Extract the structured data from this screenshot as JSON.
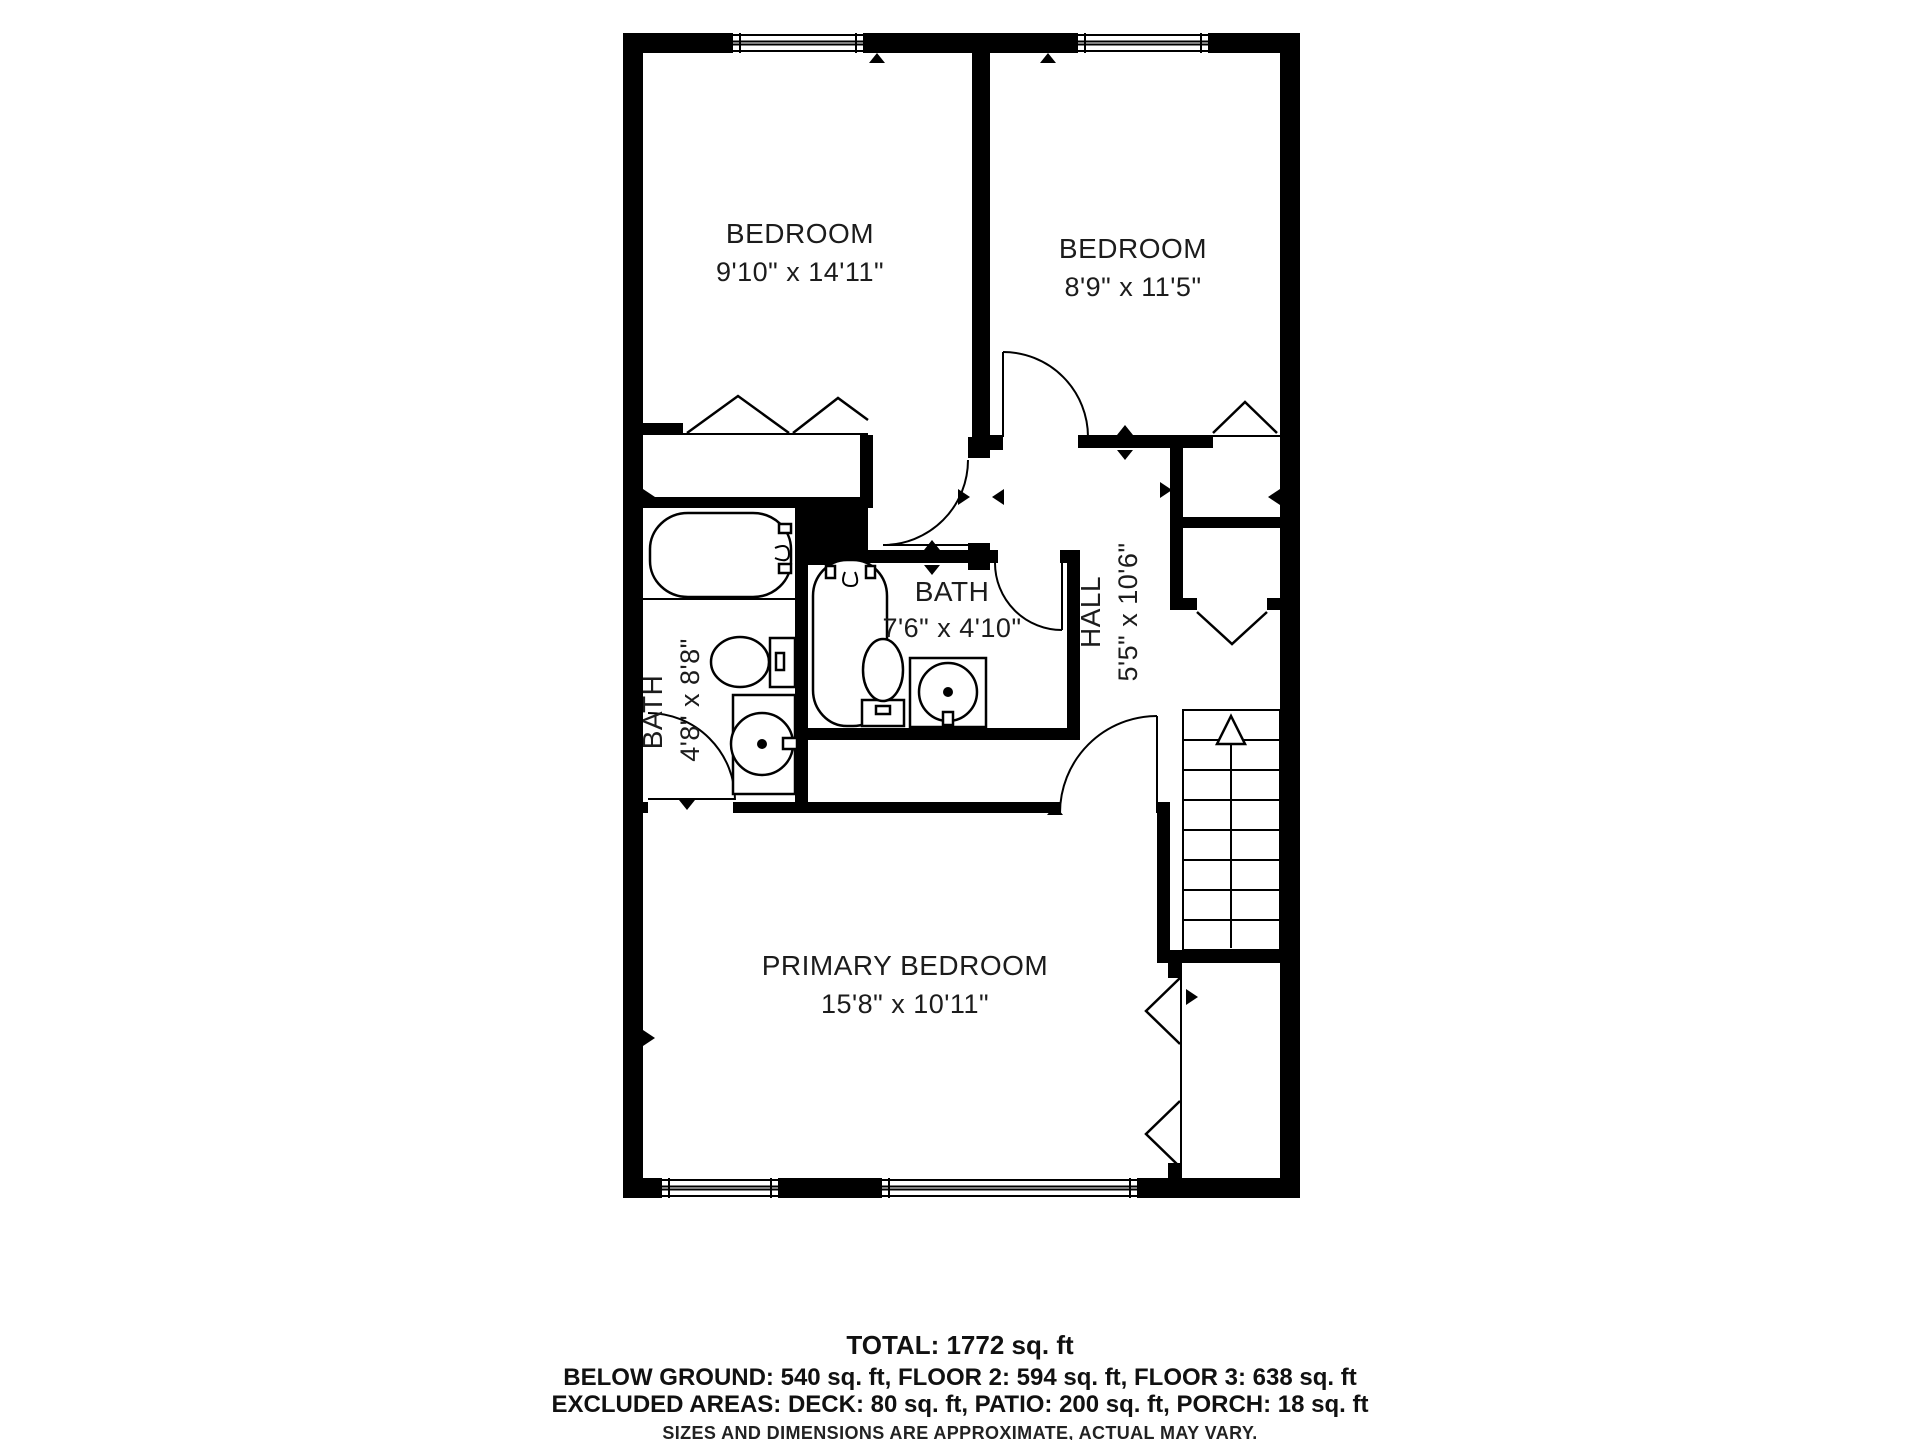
{
  "floorplan": {
    "rooms": {
      "bedroom_left": {
        "name": "BEDROOM",
        "dims": "9'10\" x 14'11\""
      },
      "bedroom_right": {
        "name": "BEDROOM",
        "dims": "8'9\" x 11'5\""
      },
      "bath_left": {
        "name": "BATH",
        "dims": "4'8\" x 8'8\""
      },
      "bath_middle": {
        "name": "BATH",
        "dims": "7'6\" x 4'10\""
      },
      "hall": {
        "name": "HALL",
        "dims": "5'5\" x 10'6\""
      },
      "primary_bedroom": {
        "name": "PRIMARY BEDROOM",
        "dims": "15'8\" x 10'11\""
      }
    },
    "features": {
      "stairs_direction": "up",
      "window_count": 4,
      "closet_bifold_count": 6
    },
    "summary": {
      "total": "TOTAL: 1772 sq. ft",
      "floors": "BELOW GROUND: 540 sq. ft, FLOOR 2: 594 sq. ft, FLOOR 3: 638 sq. ft",
      "excluded": "EXCLUDED AREAS: DECK: 80 sq. ft, PATIO: 200 sq. ft, PORCH: 18 sq. ft",
      "disclaimer": "SIZES AND DIMENSIONS ARE APPROXIMATE, ACTUAL MAY VARY."
    },
    "colors": {
      "wall": "#000000",
      "background": "#ffffff",
      "text": "#1c1c1c"
    }
  }
}
